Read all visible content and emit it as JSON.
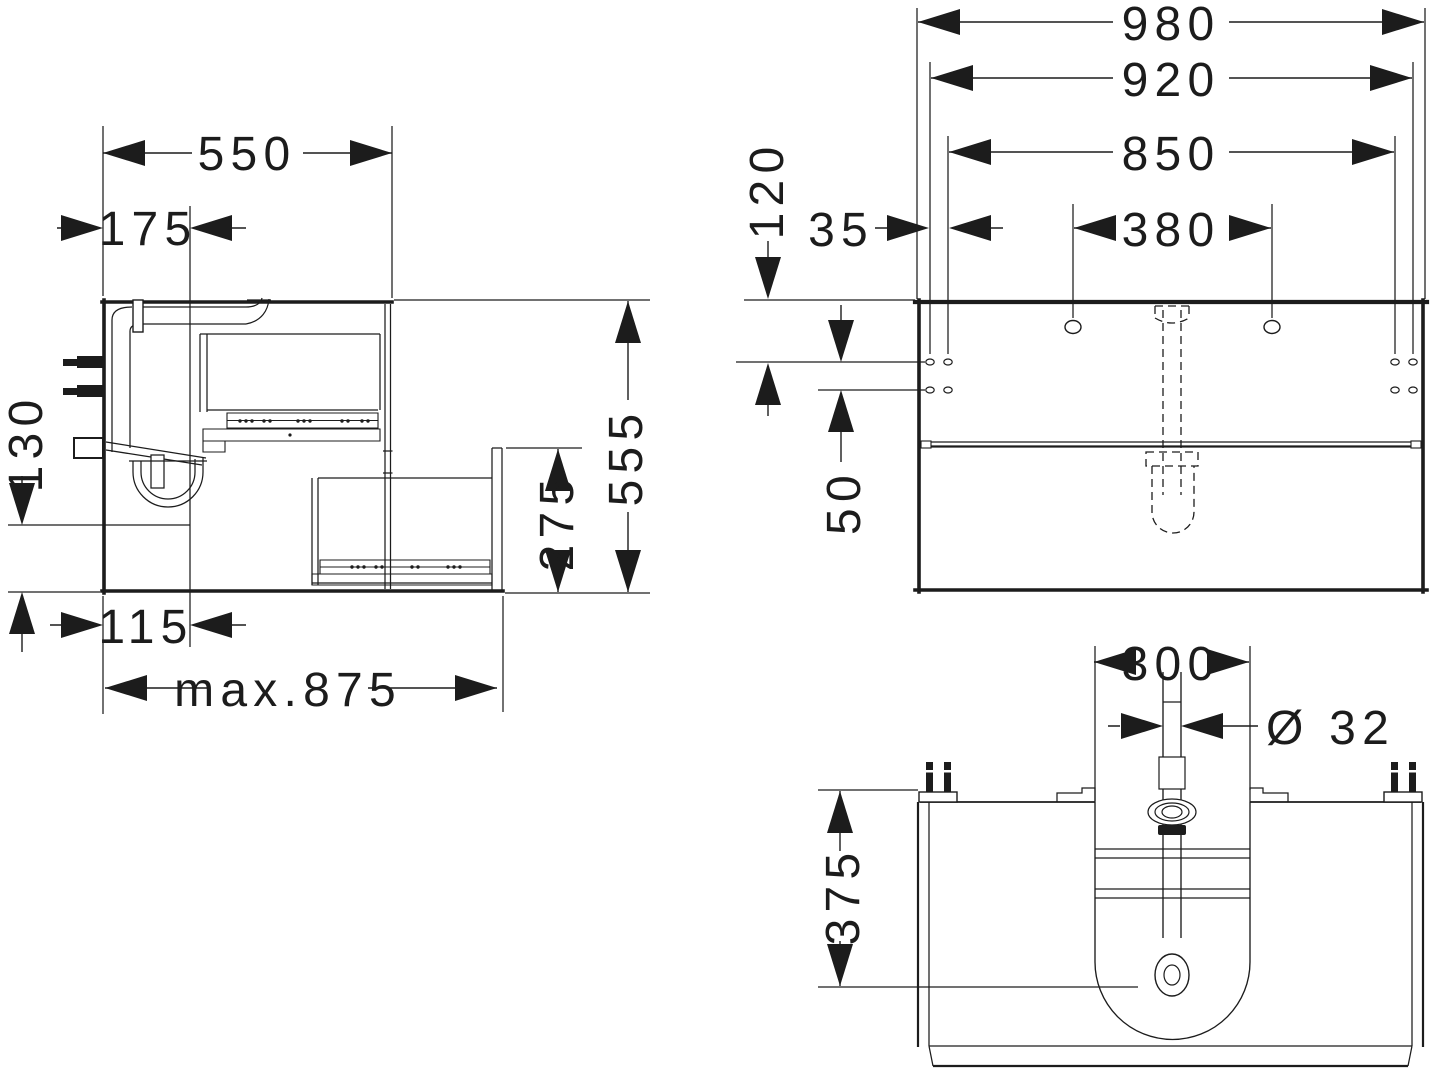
{
  "drawing": {
    "kind": "furniture-installation-dimension-drawing",
    "views": [
      "side-section",
      "front",
      "bottom"
    ]
  },
  "colors": {
    "line": "#1c1c1c",
    "background": "#ffffff"
  },
  "dims": {
    "side_width": "550",
    "side_drain_offset": "175",
    "side_recess_height": "130",
    "side_bottom_offset": "115",
    "side_max_depth": "max.875",
    "side_height": "555",
    "side_drawer_front": "275",
    "front_width": "980",
    "front_mount_width": "920",
    "front_hole_span": "850",
    "front_top_to_holes": "120",
    "front_edge_gap": "35",
    "front_faucet_span": "380",
    "front_row_gap": "50",
    "bottom_cutout_width": "300",
    "bottom_pipe_diameter": "Ø 32",
    "bottom_trap_depth": "375"
  }
}
